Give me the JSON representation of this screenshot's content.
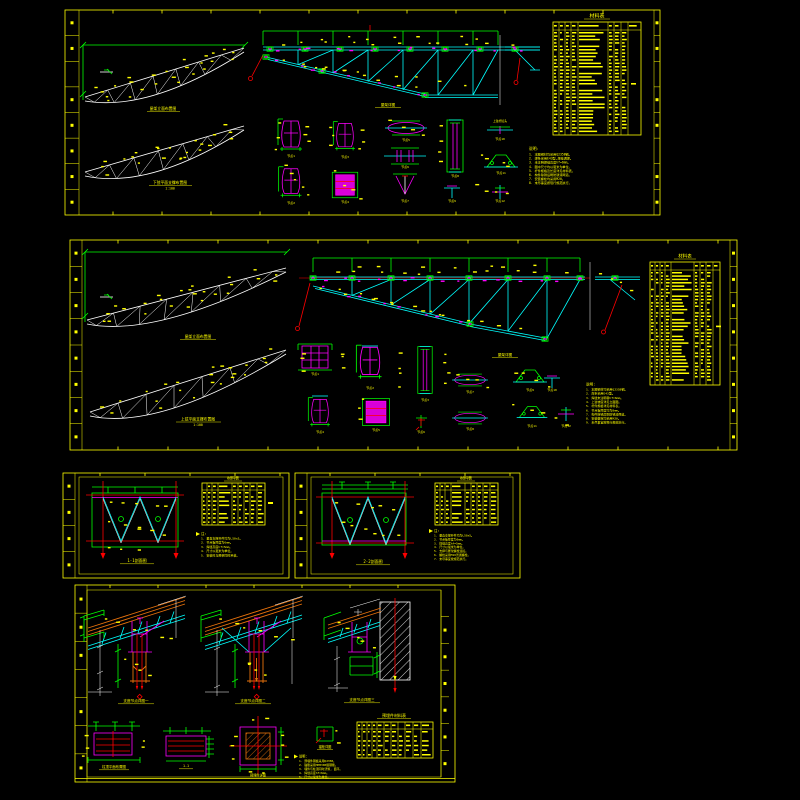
{
  "document": {
    "type": "钢屋架结构施工图",
    "background": "#000000"
  },
  "colors": {
    "frame": "#FFFF00",
    "outline": "#FFFFFF",
    "member": "#00FFFF",
    "plate": "#FF00FF",
    "dimension": "#00FF00",
    "alert": "#FF0000",
    "purlin": "#E8720C"
  },
  "panel1": {
    "elevation_label": "屋架立面布置图",
    "plan_label": "下弦平面支撑布置图",
    "plan_scale": "1:100",
    "detail_label": "屋架详图",
    "chord_note": "上弦杆接头",
    "table_title": "材料表",
    "notes_title": "说明:",
    "notes": [
      "1. 本图钢材均采用Q235B钢。",
      "2. 焊条采用E43型,焊缝满焊。",
      "3. 未注明焊缝高度hf=6mm。",
      "4. 图中尺寸均以毫米为单位。",
      "5. 杆件规格及长度详见材料表。",
      "6. 构件除锈后刷防锈漆两道。",
      "7. 安装螺栓均采用M20。",
      "8. 未尽事宜按现行规范执行。"
    ],
    "detail_labels": [
      "节点1",
      "节点2",
      "节点3",
      "节点4",
      "节点5",
      "节点6",
      "节点7",
      "节点8",
      "节点9",
      "节点10",
      "节点11",
      "节点12"
    ]
  },
  "panel2": {
    "elevation_label": "屋架立面布置图",
    "plan_label": "上弦平面支撑布置图",
    "plan_scale": "1:100",
    "detail_label": "屋架详图",
    "table_title": "材料表",
    "notes_title": "说明:",
    "notes": [
      "1. 本图钢材均采用Q235B钢。",
      "2. 焊条采用E43型。",
      "3. 焊缝未注明者hf=6mm。",
      "4. 上弦坡度详见立面图。",
      "5. 杆件规格详见材料表。",
      "6. 节点板厚度均为8mm。",
      "7. 构件除锈后刷防锈漆两道。",
      "8. 安装螺栓均采用M20。",
      "9. 未尽事宜按现行规范执行。"
    ],
    "detail_labels": [
      "节点1",
      "节点2",
      "节点3",
      "节点4",
      "节点5",
      "节点6",
      "节点7",
      "节点8",
      "节点9",
      "节点10",
      "节点11",
      "节点12"
    ]
  },
  "panel3": {
    "section_label": "1-1剖面图",
    "table_title": "材料表",
    "notes_title": "注:",
    "notes": [
      "1. 垂直支撑杆件均为L50x5。",
      "2. 节点板厚度为6mm。",
      "3. 焊缝高度hf=5mm。",
      "4. 尺寸以毫米为单位。",
      "5. 安装时与屋架同时吊装。"
    ]
  },
  "panel4": {
    "section_label": "2-2剖面图",
    "table_title": "材料表",
    "notes_title": "注:",
    "notes": [
      "1. 垂直支撑杆件均为L50x5。",
      "2. 节点板厚度为6mm。",
      "3. 焊缝高度hf=5mm。",
      "4. 尺寸以毫米为单位。",
      "5. 支撑与屋架螺栓连接。",
      "6. 螺栓采用M16普通螺栓。",
      "7. 未尽事宜按规范执行。"
    ]
  },
  "panel5": {
    "detail1_label": "支座节点详图一",
    "detail2_label": "支座节点详图二",
    "detail3_label": "支座节点详图三",
    "plan1_label": "柱顶平面布置图",
    "plan2_label": "1-1",
    "embed_label": "预埋件详图",
    "anchor_label": "锚栓详图",
    "table_title": "预埋件材料表",
    "notes_title": "说明:",
    "notes": [
      "1. 预埋件钢板采用Q235B。",
      "2. 锚筋采用HPB300级钢筋。",
      "3. 埋件与柱顶同时浇筑, 面平。",
      "4. 焊缝高度hf=6mm。",
      "5. 尺寸以毫米为单位。"
    ]
  }
}
